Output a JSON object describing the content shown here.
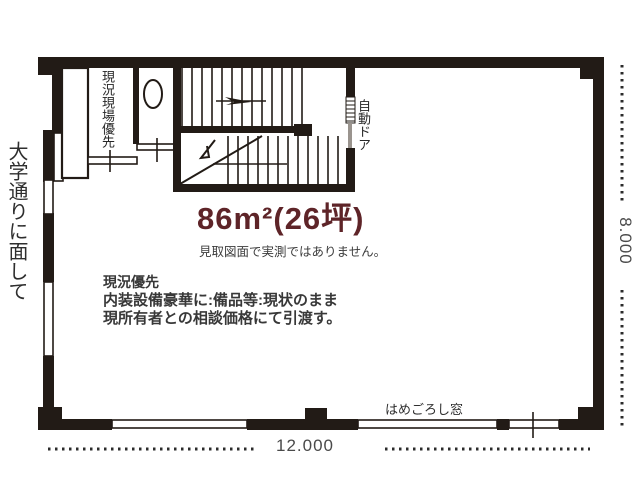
{
  "plan": {
    "title": "86m²(26坪)",
    "disclaimer": "見取図面で実測ではありません。",
    "street_label": "大学通りに面して",
    "room_label": "現況現場優先",
    "auto_door_label": "自動ドア",
    "fixed_window_label": "はめごろし窓",
    "note_title": "現況優先",
    "note_line1": "内装設備豪華に:備品等:現状のまま",
    "note_line2": "現所有者との相談価格にて引渡す。",
    "dim_width": "12.000",
    "dim_height": "8.000",
    "colors": {
      "wall": "#221b16",
      "title_accent": "#5e2428",
      "body_text": "#383838",
      "dimension_text": "#4a4a4a"
    }
  }
}
